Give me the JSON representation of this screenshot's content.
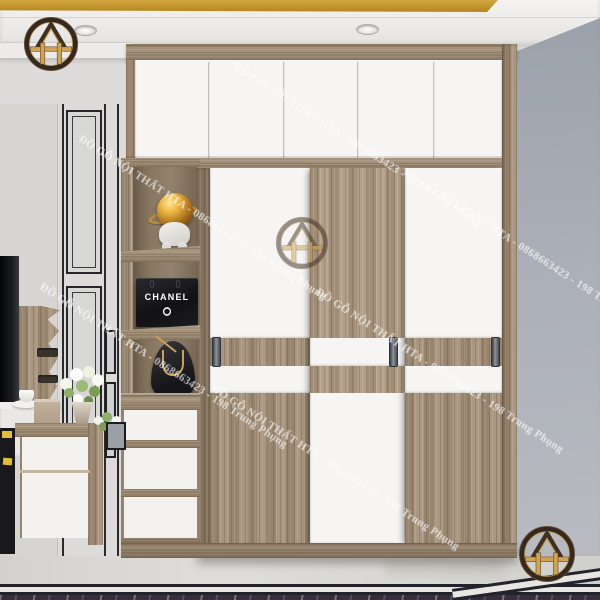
{
  "watermark": {
    "text": "ĐỒ GỖ NỘI THẤT HTA - 0868663423 - 198 Trung Phụng",
    "brand": "HTA",
    "phone": "0868663423",
    "address": "198 Trung Phụng",
    "angle_deg": 33,
    "instances": [
      {
        "x": 238,
        "y": 60
      },
      {
        "x": 83,
        "y": 133
      },
      {
        "x": 408,
        "y": 166
      },
      {
        "x": 44,
        "y": 281
      },
      {
        "x": 320,
        "y": 286
      },
      {
        "x": 216,
        "y": 383
      }
    ]
  },
  "brand_logo": {
    "name": "hta-house-logo",
    "positions": {
      "top-left": {
        "x": 23,
        "y": 16,
        "size": 56,
        "opacity": 1
      },
      "wardrobe-center": {
        "x": 275,
        "y": 216,
        "size": 54,
        "opacity": 0.5
      },
      "bottom-right": {
        "x": 518,
        "y": 525,
        "size": 58,
        "opacity": 1
      }
    }
  },
  "products": {
    "bag_brand": "CHANEL"
  },
  "colors": {
    "ceiling_gold": "#c49a35",
    "wall_gray": "#a9aeb6",
    "wall_left": "#dcdbd9",
    "wood": "#a49179",
    "wood_dark": "#8b7a64",
    "panel_white": "#f6f5f3",
    "floor_gray": "#d7d6d3",
    "marble_dark": "#352f3d",
    "handle_gray": "#565b62",
    "gold_accent": "#c9a255",
    "bag_black": "#17171a"
  }
}
